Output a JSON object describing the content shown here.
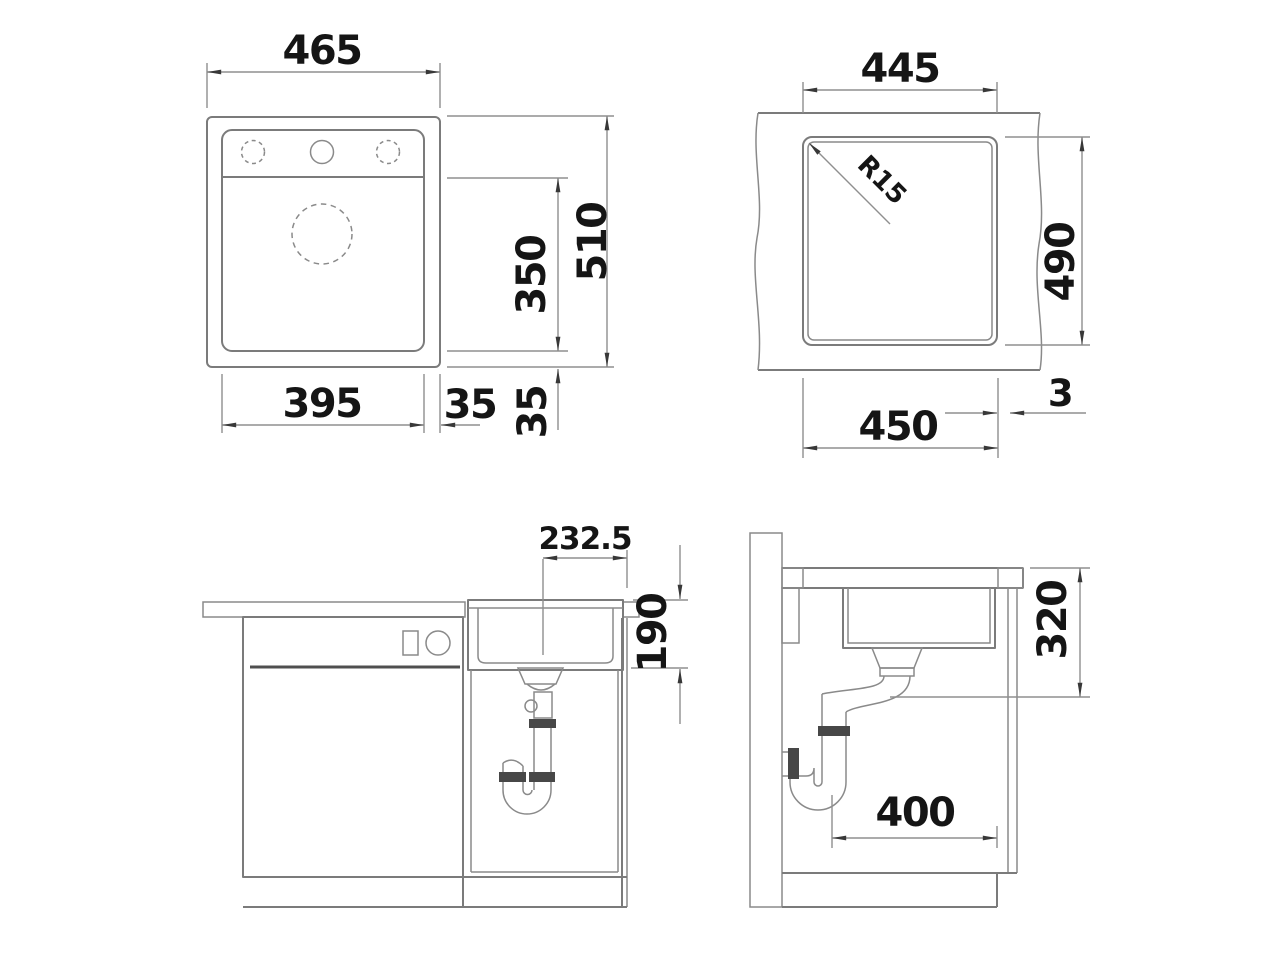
{
  "drawing": {
    "colors": {
      "background": "#ffffff",
      "geometry_line": "#7b7b7b",
      "dimension_line": "#8f8f8f",
      "arrowhead": "#383838",
      "label_text": "#151515",
      "pipe_collar_fill": "#474747"
    },
    "top_view": {
      "overall_width": "465",
      "overall_depth": "510",
      "bowl_depth_from_deck": "350",
      "bowl_width": "395",
      "side_margin": "35",
      "bottom_margin": "35"
    },
    "cutout_view": {
      "cutout_width_top": "445",
      "cutout_depth": "490",
      "cutout_width_bottom": "450",
      "corner_radius": "R15",
      "edge_gap": "3"
    },
    "front_view": {
      "drain_center_offset": "232.5",
      "bowl_inner_depth": "190"
    },
    "side_view": {
      "install_depth_below_top": "320",
      "rear_clearance": "400"
    }
  }
}
